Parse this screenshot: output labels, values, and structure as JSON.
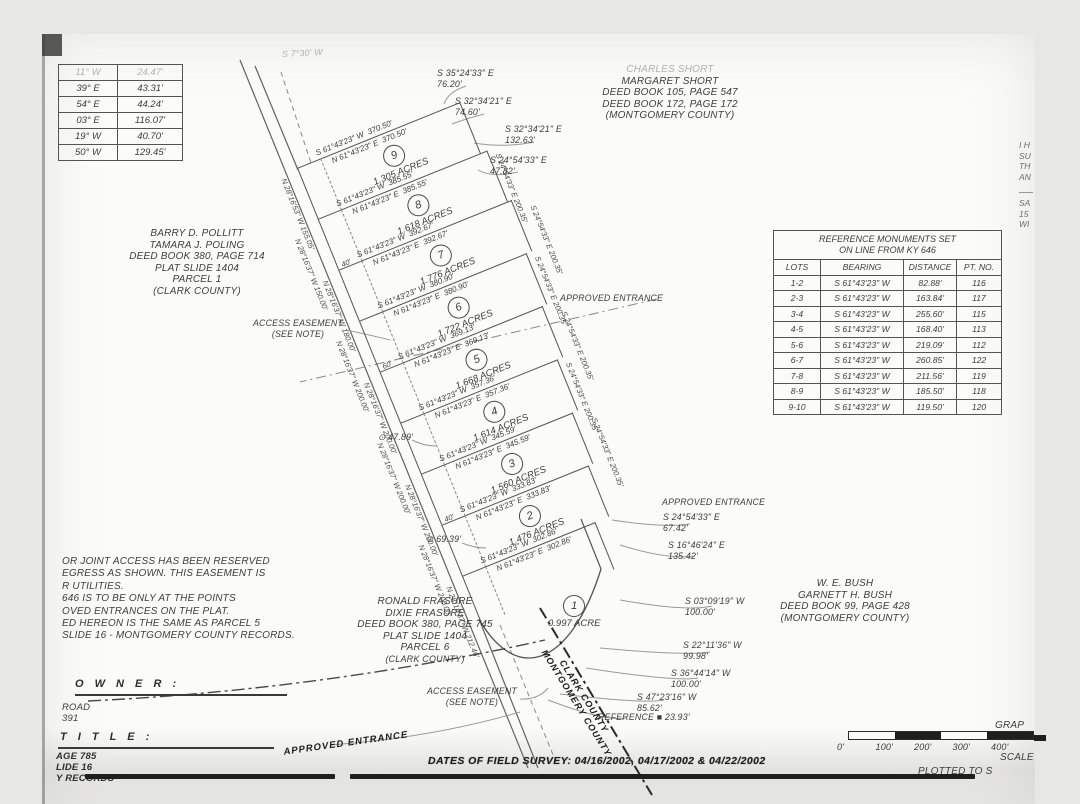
{
  "corner_table": {
    "rows": [
      [
        "11° W",
        "24.47'"
      ],
      [
        "39° E",
        "43.31'"
      ],
      [
        "54° E",
        "44.24'"
      ],
      [
        "03° E",
        "116.07'"
      ],
      [
        "19° W",
        "40.70'"
      ],
      [
        "50° W",
        "129.45'"
      ]
    ]
  },
  "adjoiners": {
    "short": {
      "l1": "CHARLES SHORT",
      "l2": "MARGARET SHORT",
      "l3": "DEED BOOK 105, PAGE 547",
      "l4": "DEED BOOK 172, PAGE 172",
      "l5": "(MONTGOMERY COUNTY)"
    },
    "pollitt": {
      "l1": "BARRY D. POLLITT",
      "l2": "TAMARA J. POLING",
      "l3": "DEED BOOK 380, PAGE 714",
      "l4": "PLAT SLIDE 1404",
      "l5": "PARCEL 1",
      "l6": "(CLARK COUNTY)"
    },
    "frasure": {
      "l1": "RONALD FRASURE",
      "l2": "DIXIE FRASURE",
      "l3": "DEED BOOK 380, PAGE 745",
      "l4": "PLAT SLIDE 1404",
      "l5": "PARCEL 6",
      "l6": "(CLARK COUNTY)"
    },
    "bush": {
      "l1": "W. E. BUSH",
      "l2": "GARNETT H. BUSH",
      "l3": "DEED BOOK 99, PAGE 428",
      "l4": "(MONTGOMERY COUNTY)"
    }
  },
  "ref_table": {
    "title1": "REFERENCE MONUMENTS SET",
    "title2": "ON LINE FROM KY 646",
    "headers": [
      "LOTS",
      "BEARING",
      "DISTANCE",
      "PT. NO."
    ],
    "rows": [
      [
        "1-2",
        "S 61°43'23\" W",
        "82.88'",
        "116"
      ],
      [
        "2-3",
        "S 61°43'23\" W",
        "163.84'",
        "117"
      ],
      [
        "3-4",
        "S 61°43'23\" W",
        "255.60'",
        "115"
      ],
      [
        "4-5",
        "S 61°43'23\" W",
        "168.40'",
        "113"
      ],
      [
        "5-6",
        "S 61°43'23\" W",
        "219.09'",
        "112"
      ],
      [
        "6-7",
        "S 61°43'23\" W",
        "260.85'",
        "122"
      ],
      [
        "7-8",
        "S 61°43'23\" W",
        "211.56'",
        "119"
      ],
      [
        "8-9",
        "S 61°43'23\" W",
        "185.50'",
        "118"
      ],
      [
        "9-10",
        "S 61°43'23\" W",
        "119.50'",
        "120"
      ]
    ]
  },
  "plat": {
    "bearing_s": "S 61°43'23\" W",
    "bearing_n": "N 61°43'23\" E",
    "lots": [
      {
        "num": "9",
        "acres": "1.305 ACRES",
        "len": "370.50'",
        "left": "N 28°16'53\" W  155.05'",
        "right": "",
        "gap": ""
      },
      {
        "num": "8",
        "acres": "1.618 ACRES",
        "len": "385.55'",
        "left": "N 28°16'37\" W  150.00'",
        "right": "S 24°54'33\" E  200.35'",
        "gap": ""
      },
      {
        "num": "7",
        "acres": "1.776 ACRES",
        "len": "392.67'",
        "left": "N 28°16'37\" W  180.00'",
        "right": "S 24°54'33\" E  200.35'",
        "gap": "40'"
      },
      {
        "num": "6",
        "acres": "1.722 ACRES",
        "len": "380.90'",
        "left": "N 28°16'37\" W  200.00'",
        "right": "S 24°54'33\" E  200.35'",
        "gap": ""
      },
      {
        "num": "5",
        "acres": "1.668 ACRES",
        "len": "369.13'",
        "left": "N 28°16'37\" W  200.00'",
        "right": "S 24°54'33\" E  200.35'",
        "gap": "60'"
      },
      {
        "num": "4",
        "acres": "1.614 ACRES",
        "len": "357.36'",
        "left": "N 28°16'37\" W  200.00'",
        "right": "S 24°54'33\" E  200.35'",
        "gap": ""
      },
      {
        "num": "3",
        "acres": "1.560 ACRES",
        "len": "345.59'",
        "left": "N 28°16'37\" W  200.00'",
        "right": "S 24°54'33\" E  200.35'",
        "gap": ""
      },
      {
        "num": "2",
        "acres": "1.476 ACRES",
        "len": "333.83'",
        "left": "N 28°16'37\" W  200.00'",
        "right": "",
        "gap": "40'"
      },
      {
        "num": "1",
        "acres": "0.997 ACRE",
        "len": "302.86'",
        "left": "N 28°16'37\" W  212.46'",
        "right": "",
        "gap": ""
      }
    ]
  },
  "callouts": {
    "faint_top": "S 7°30' W",
    "c1": "S 35°24'33\" E\n76.20'",
    "c2": "S 32°34'21\" E\n74.60'",
    "c3": "S 32°34'21\" E\n132.63'",
    "c4": "S 24°54'33\" E\n47.82'",
    "appr1": "APPROVED ENTRANCE",
    "appr2": "APPROVED ENTRANCE",
    "c5": "S 24°54'33\" E\n67.42'",
    "c6": "S 16°46'24\" E\n135.42'",
    "c7": "S 03°09'19\" W\n100.00'",
    "c8": "S 22°11'36\" W\n99.98'",
    "c9": "S 36°44'14\" W\n100.00'",
    "c10": "S 47°23'16\" W\n85.62'",
    "ref_mark": "REFERENCE ■ 23.93'",
    "ae1": "ACCESS EASEMENT\n(SEE NOTE)",
    "ae2": "ACCESS EASEMENT\n(SEE NOTE)",
    "o47": "⊙ 47.89'",
    "o69": "⊙ 69.39'",
    "appr3": "APPROVED ENTRANCE",
    "county1": "MONTGOMERY COUNTY",
    "county2": "CLARK COUNTY"
  },
  "notes": {
    "lines": [
      "OR JOINT ACCESS HAS BEEN RESERVED",
      "EGRESS AS SHOWN. THIS EASEMENT IS",
      "R UTILITIES.",
      "646 IS TO BE ONLY AT THE POINTS",
      "OVED ENTRANCES ON THE PLAT.",
      "ED HEREON IS THE SAME AS PARCEL 5",
      "SLIDE 16 - MONTGOMERY COUNTY RECORDS."
    ]
  },
  "owner": {
    "label": "O W N E R :",
    "road": "ROAD",
    "number": "391"
  },
  "title_block": {
    "label": "T I T L E :",
    "lines": [
      "AGE 785",
      "LIDE 16",
      "Y RECORDS"
    ]
  },
  "edge_fragments": {
    "top": "I H\nSU\nTH\nAN",
    "bottom": "SA\n15\nWI"
  },
  "scale": {
    "labels": [
      "0'",
      "100'",
      "200'",
      "300'",
      "400'"
    ],
    "graphic": "GRAP",
    "scale_word": "SCALE",
    "plotted": "PLOTTED TO S"
  },
  "survey": {
    "dates": "DATES OF FIELD SURVEY:  04/16/2002, 04/17/2002 & 04/22/2002"
  }
}
